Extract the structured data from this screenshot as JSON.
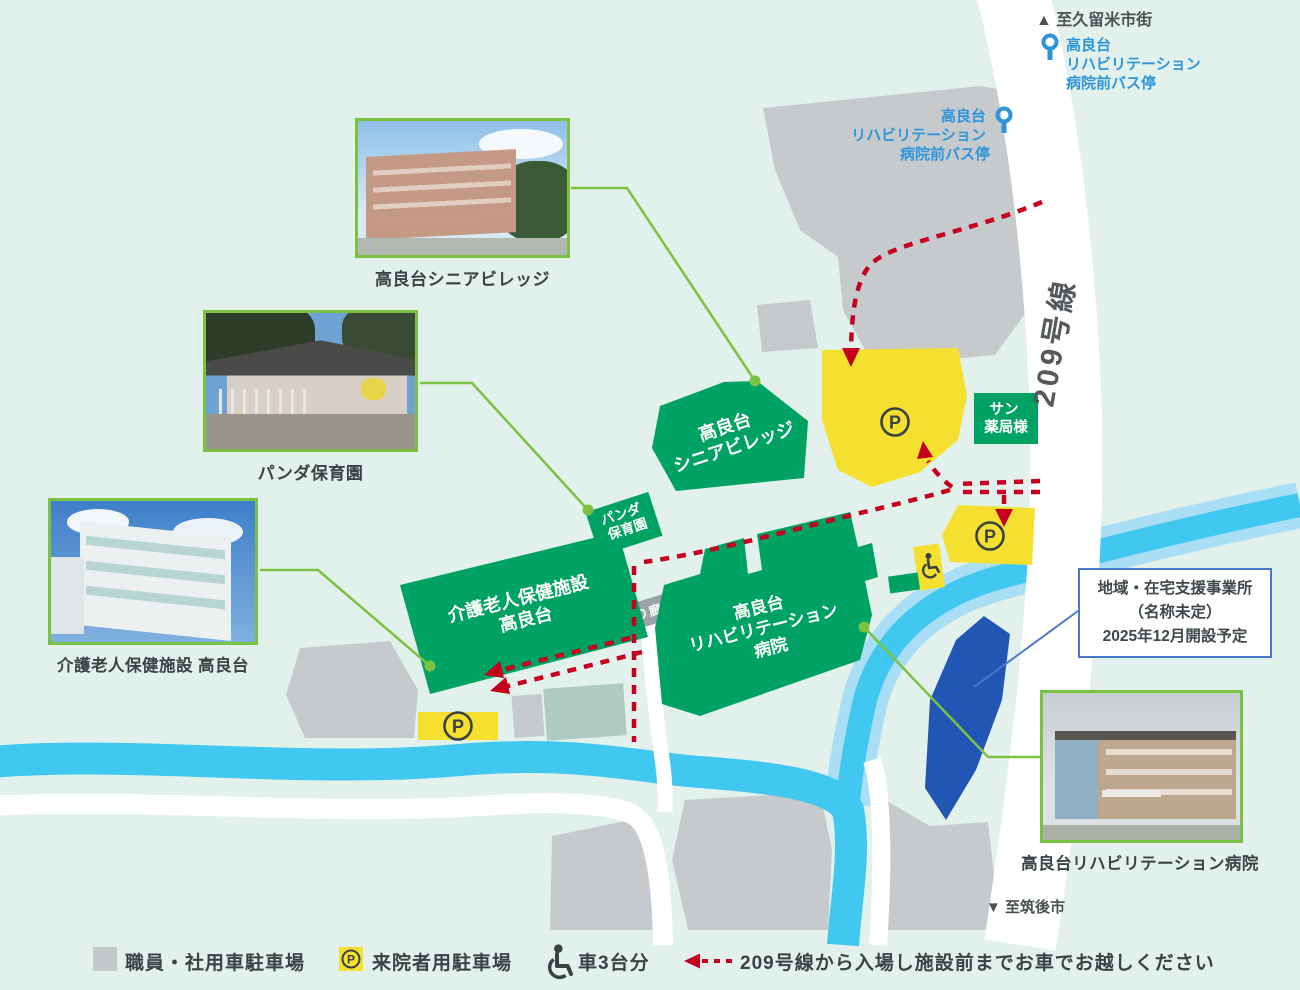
{
  "map": {
    "direction_north": "▲ 至久留米市街",
    "direction_south": "▼ 至筑後市",
    "route_209": "209号線",
    "bus_stop_lines": [
      "高良台",
      "リハビリテーション",
      "病院前バス停"
    ],
    "buildings": {
      "senior_village": {
        "line1": "高良台",
        "line2": "シニアビレッジ"
      },
      "panda_nursery": {
        "line1": "パンダ",
        "line2": "保育園"
      },
      "kaigo_rojin": {
        "line1": "介護老人保健施設",
        "line2": "高良台"
      },
      "rehab_hospital": {
        "line1": "高良台",
        "line2": "リハビリテーション",
        "line3": "病院"
      },
      "sun_pharmacy": {
        "line1": "サン",
        "line2": "薬局様"
      }
    },
    "corridor": "渡り廊下",
    "parking_mark": "P",
    "info_box": {
      "line1": "地域・在宅支援事業所",
      "line2": "（名称未定）",
      "line3": "2025年12月開設予定"
    },
    "photos": {
      "senior_village_caption": "高良台シニアビレッジ",
      "panda_caption": "パンダ保育園",
      "kaigo_caption": "介護老人保健施設 高良台",
      "hospital_caption": "高良台リハビリテーション病院"
    }
  },
  "legend": {
    "staff_parking": "職員・社用車駐車場",
    "visitor_parking": "来院者用駐車場",
    "wheelchair_spaces": "車3台分",
    "route_instruction": "209号線から入場し施設前までお車でお越しください"
  },
  "colors": {
    "background": "#e3f1ec",
    "building_green": "#00a263",
    "parking_yellow": "#f5e030",
    "staff_gray": "#c6cacc",
    "river_cyan": "#41c8f0",
    "river_pale": "#aadef4",
    "route_red": "#c5001e",
    "bus_stop_blue": "#2e96d8",
    "planned_site_blue": "#2156b4",
    "photo_border_green": "#7cc242",
    "info_border_blue": "#4a78c8"
  }
}
